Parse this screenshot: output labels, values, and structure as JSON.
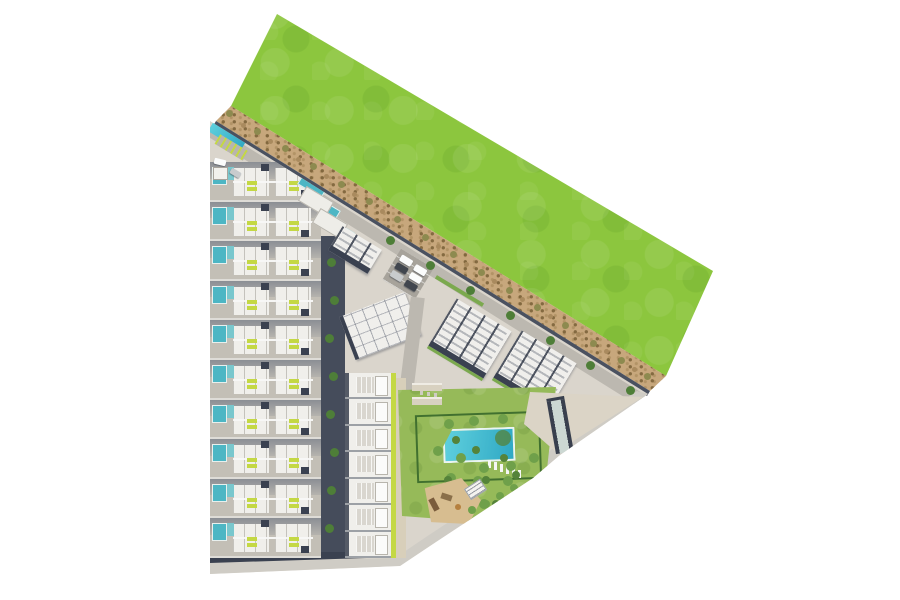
{
  "meta": {
    "description": "Aerial 3D site plan rendering of a residential development with townhouse rows, angled apartment blocks, communal pool garden, playground and car park, bordered by a green field and a dirt track",
    "background": "#ffffff"
  },
  "palette": {
    "grass": "#8cc63e",
    "dirt": "#c7a77c",
    "shrub": "#8d8a4f",
    "concrete": "#dad5cc",
    "road": "#bcb8b0",
    "road-light": "#cfccc5",
    "alley": "#454c5b",
    "navy": "#3a4150",
    "pool-teal": "#4db6c4",
    "lime": "#c4d844",
    "lawn": "#96ba59",
    "lawn-dark": "#6f9a43",
    "hedge": "#41702f",
    "tree": "#6fa04a",
    "tree-dark": "#55833a",
    "palm": "#4e7e38",
    "sand": "#d7bd90",
    "car-white": "#fbfcfc",
    "car-dark": "#41464e",
    "car-silver": "#c8cbcd"
  },
  "areas": {
    "green_field": "undeveloped green field",
    "dirt_road": "dirt track with shrubs",
    "development": "residential development",
    "townhouses": "townhouse rows with private pools",
    "apartments": "apartment blocks",
    "garden": "communal garden with swimming pool",
    "playground": "children playground",
    "parking": "car park",
    "ramp": "parking ramp"
  },
  "counts": {
    "townhouse_rows": 10,
    "apartment_strip_units": 7,
    "block_a_units": 2,
    "block_b_units": 4,
    "block_c_units": 4,
    "parking_cars": 6,
    "back_pool_strips": 3
  }
}
